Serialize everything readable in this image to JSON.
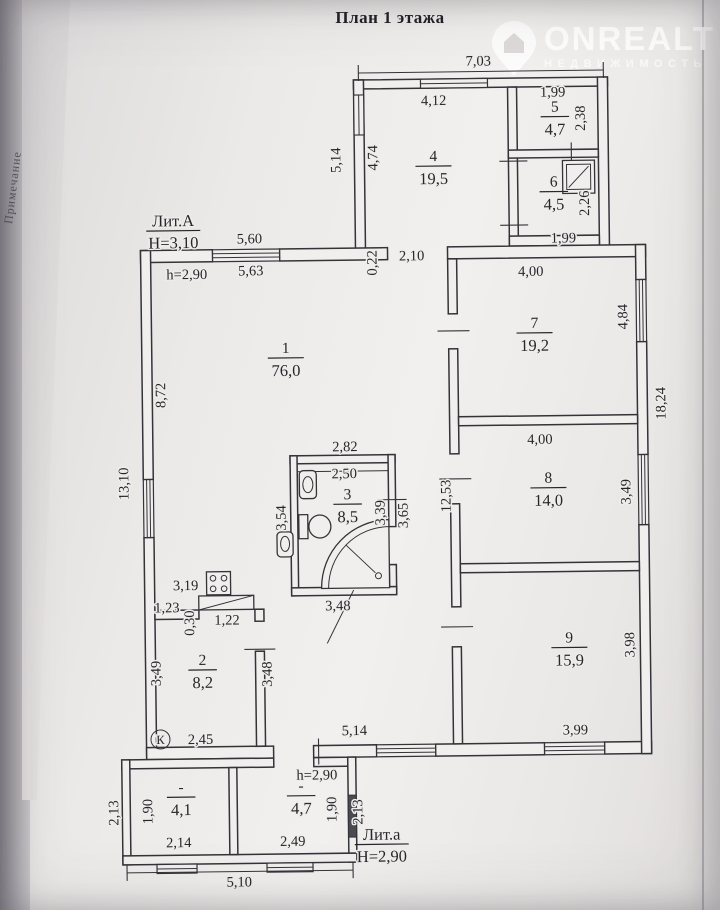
{
  "page": {
    "title": "План 1 этажа",
    "side_label": "Примечание"
  },
  "watermark": {
    "brand": "ONREALT",
    "tagline": "НЕДВИЖИМОСТЬ"
  },
  "colors": {
    "background": "#b6b3b7",
    "paper": "#efedeb",
    "line": "#33333a",
    "text": "#26262c",
    "watermark": "#ffffff"
  },
  "plan": {
    "kitchen_marker": "К",
    "buildings": [
      {
        "name": "Лит.А",
        "height": "Н=3,10",
        "x": 176,
        "y": 224
      },
      {
        "name": "Лит.а",
        "height": "Н=2,90",
        "x": 377,
        "y": 840
      }
    ],
    "rooms": [
      {
        "num": "1",
        "area": "76,0",
        "x": 287,
        "y": 352
      },
      {
        "num": "2",
        "area": "8,2",
        "x": 200,
        "y": 663
      },
      {
        "num": "3",
        "area": "8,5",
        "x": 347,
        "y": 499
      },
      {
        "num": "4",
        "area": "19,5",
        "x": 437,
        "y": 162
      },
      {
        "num": "5",
        "area": "4,7",
        "x": 559,
        "y": 114
      },
      {
        "num": "6",
        "area": "4,5",
        "x": 557,
        "y": 189
      },
      {
        "num": "7",
        "area": "19,2",
        "x": 536,
        "y": 330
      },
      {
        "num": "8",
        "area": "14,0",
        "x": 548,
        "y": 485
      },
      {
        "num": "9",
        "area": "15,9",
        "x": 567,
        "y": 645
      },
      {
        "num": "-",
        "area": "4,1",
        "x": 177,
        "y": 790
      },
      {
        "num": "-",
        "area": "4,7",
        "x": 297,
        "y": 790
      }
    ],
    "dims": [
      {
        "t": "7,03",
        "x": 483,
        "y": 67
      },
      {
        "t": "4,12",
        "x": 438,
        "y": 106
      },
      {
        "t": "1,99",
        "x": 557,
        "y": 99
      },
      {
        "t": "2,38",
        "x": 589,
        "y": 121,
        "r": -90
      },
      {
        "t": "5,14",
        "x": 344,
        "y": 160,
        "r": -90
      },
      {
        "t": "4,74",
        "x": 381,
        "y": 158,
        "r": -90
      },
      {
        "t": "2,26",
        "x": 592,
        "y": 206,
        "r": -90
      },
      {
        "t": "1,99",
        "x": 566,
        "y": 245
      },
      {
        "t": "5,60",
        "x": 252,
        "y": 242
      },
      {
        "t": "h=2,90",
        "x": 189,
        "y": 277
      },
      {
        "t": "5,63",
        "x": 253,
        "y": 274
      },
      {
        "t": "0,22",
        "x": 379,
        "y": 263,
        "r": -90,
        "s": 12.5
      },
      {
        "t": "2,10",
        "x": 414,
        "y": 261
      },
      {
        "t": "4,00",
        "x": 533,
        "y": 278
      },
      {
        "t": "4,84",
        "x": 629,
        "y": 320,
        "r": -90
      },
      {
        "t": "18,24",
        "x": 666,
        "y": 407,
        "r": -90
      },
      {
        "t": "8,72",
        "x": 166,
        "y": 393,
        "r": -90
      },
      {
        "t": "13,10",
        "x": 128,
        "y": 481,
        "r": -90
      },
      {
        "t": "2,82",
        "x": 345,
        "y": 451
      },
      {
        "t": "2,50",
        "x": 344,
        "y": 478
      },
      {
        "t": "3,54",
        "x": 285,
        "y": 517,
        "r": -90
      },
      {
        "t": "3,39",
        "x": 384,
        "y": 513,
        "r": -90
      },
      {
        "t": "3,65",
        "x": 407,
        "y": 516,
        "r": -90
      },
      {
        "t": "12,53",
        "x": 450,
        "y": 497,
        "r": -90
      },
      {
        "t": "4,00",
        "x": 540,
        "y": 446
      },
      {
        "t": "3,49",
        "x": 630,
        "y": 495,
        "r": -90
      },
      {
        "t": "3,19",
        "x": 184,
        "y": 588
      },
      {
        "t": "1,23",
        "x": 165,
        "y": 610,
        "s": 13
      },
      {
        "t": "0,30",
        "x": 192,
        "y": 621,
        "r": -90,
        "s": 13
      },
      {
        "t": "1,22",
        "x": 225,
        "y": 623
      },
      {
        "t": "3,49",
        "x": 158,
        "y": 671,
        "r": -90
      },
      {
        "t": "3,48",
        "x": 269,
        "y": 673,
        "r": -90
      },
      {
        "t": "3,48",
        "x": 336,
        "y": 610
      },
      {
        "t": "2,45",
        "x": 197,
        "y": 742
      },
      {
        "t": "5,14",
        "x": 351,
        "y": 735
      },
      {
        "t": "3,98",
        "x": 632,
        "y": 648,
        "r": -90
      },
      {
        "t": "3,99",
        "x": 572,
        "y": 737
      },
      {
        "t": "h=2,90",
        "x": 313,
        "y": 779
      },
      {
        "t": "2,13",
        "x": 114,
        "y": 810,
        "r": -90
      },
      {
        "t": "1,90",
        "x": 148,
        "y": 809,
        "r": -90
      },
      {
        "t": "2,14",
        "x": 174,
        "y": 845
      },
      {
        "t": "2,49",
        "x": 288,
        "y": 845
      },
      {
        "t": "1,90",
        "x": 332,
        "y": 809,
        "r": -90
      },
      {
        "t": "2,13",
        "x": 358,
        "y": 812,
        "r": -90
      },
      {
        "t": "5,10",
        "x": 234,
        "y": 885
      }
    ],
    "fixtures": [
      "stove",
      "kitchen-counter",
      "sink",
      "toilet",
      "washbasin",
      "corner-shower",
      "shower-tray",
      "kitchen-marker"
    ]
  }
}
